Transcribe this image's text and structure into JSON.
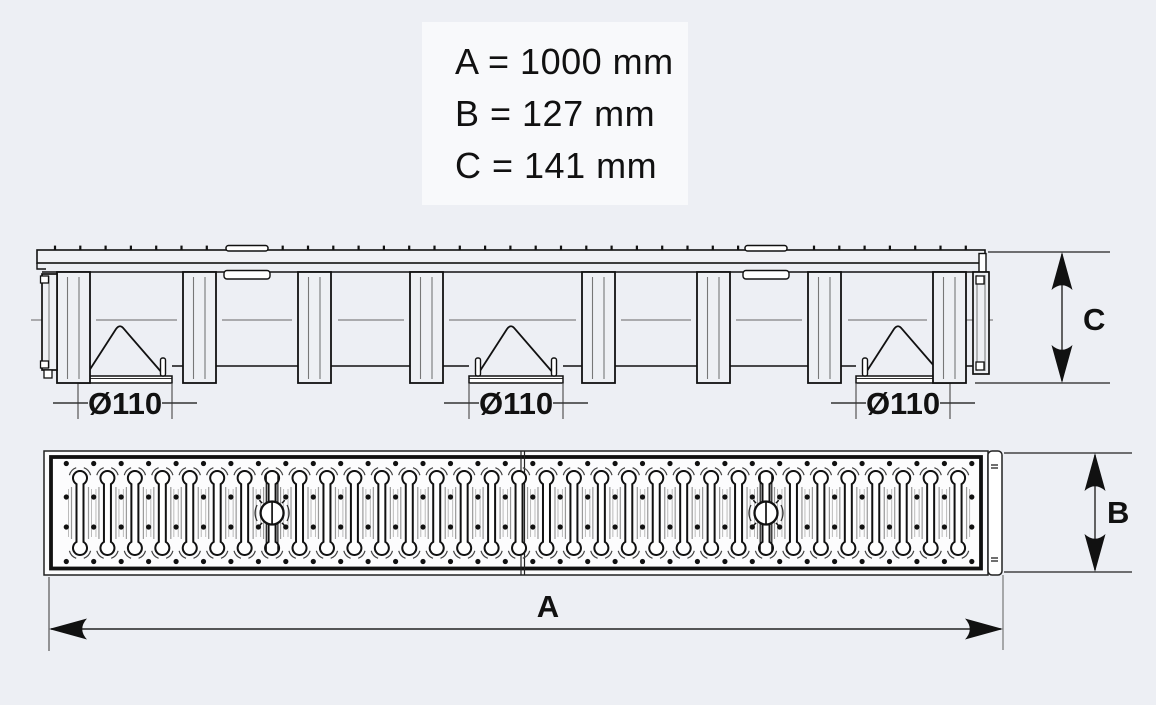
{
  "colors": {
    "background": "#edeff4",
    "legend_background": "#f8f9fb",
    "line": "#111111",
    "dim_line": "#222222"
  },
  "legend": {
    "lines": [
      "A = 1000 mm",
      "B = 127 mm",
      "C = 141 mm"
    ]
  },
  "labels": {
    "outlet_diameter": "Ø110",
    "length": "A",
    "width": "B",
    "height": "C"
  },
  "dimension_values": {
    "A_mm": 1000,
    "B_mm": 127,
    "C_mm": 141,
    "outlet_diameter_mm": 110
  }
}
